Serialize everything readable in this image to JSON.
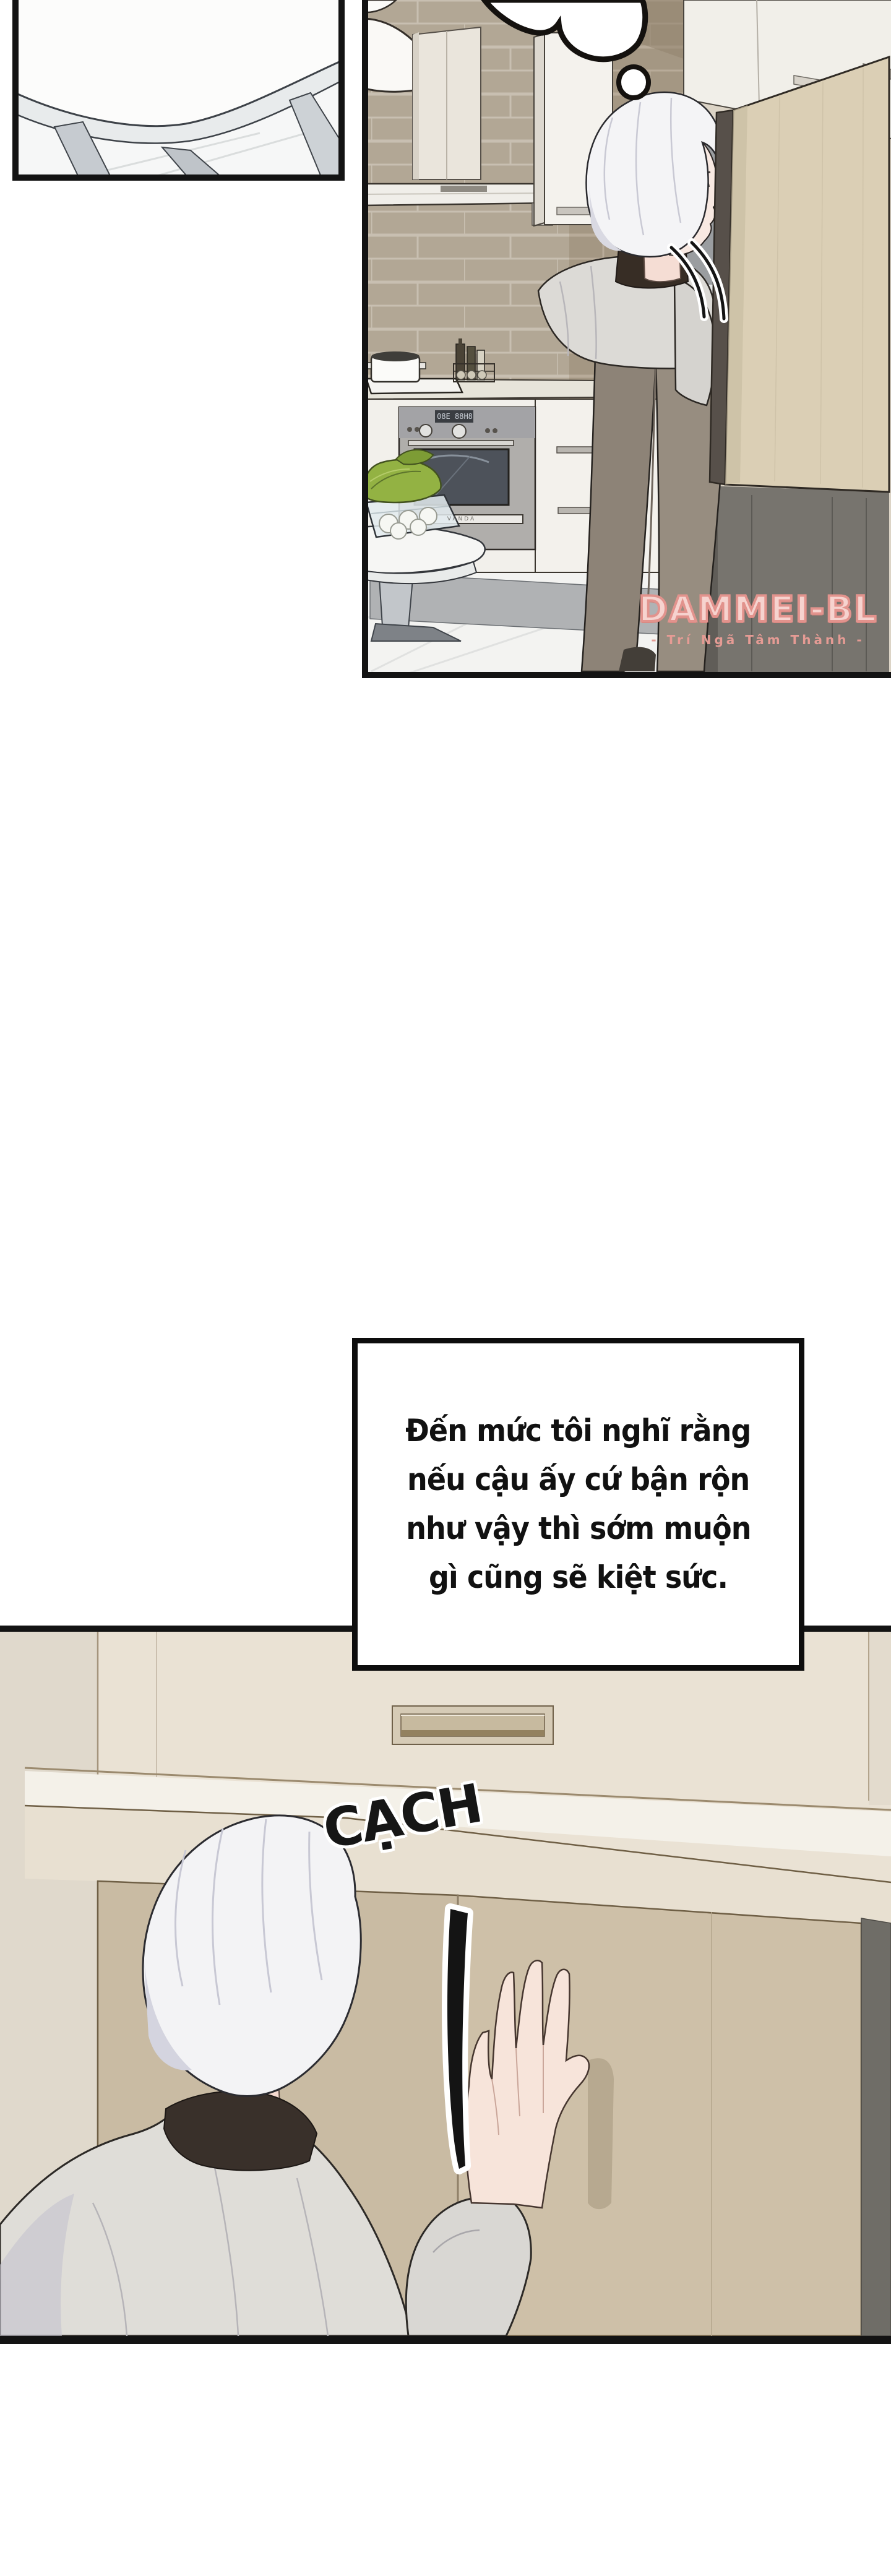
{
  "caption": {
    "lines": [
      "Đến mức tôi nghĩ rằng",
      "nếu cậu ấy cứ bận rộn",
      "như vậy thì sớm muộn",
      "gì cũng sẽ kiệt sức."
    ]
  },
  "sfx": {
    "text": "CẠCH"
  },
  "watermark": {
    "title": "DAMMEI-BL",
    "subtitle": "- Trí Ngã Tâm Thành -"
  },
  "oven": {
    "brand": "VANDA",
    "display": "08E 88H8"
  },
  "colors": {
    "ink": "#141414",
    "paper": "#ffffff",
    "brick_light": "#b2a795",
    "brick_dark": "#a49783",
    "right_wall": "#dcd4c6",
    "fridge_door": "#dbcfb5",
    "bottom_wall_beige": "#eae2d4",
    "cabinet_tan": "#c9bba3",
    "watermark_pink": "#e2938d"
  }
}
